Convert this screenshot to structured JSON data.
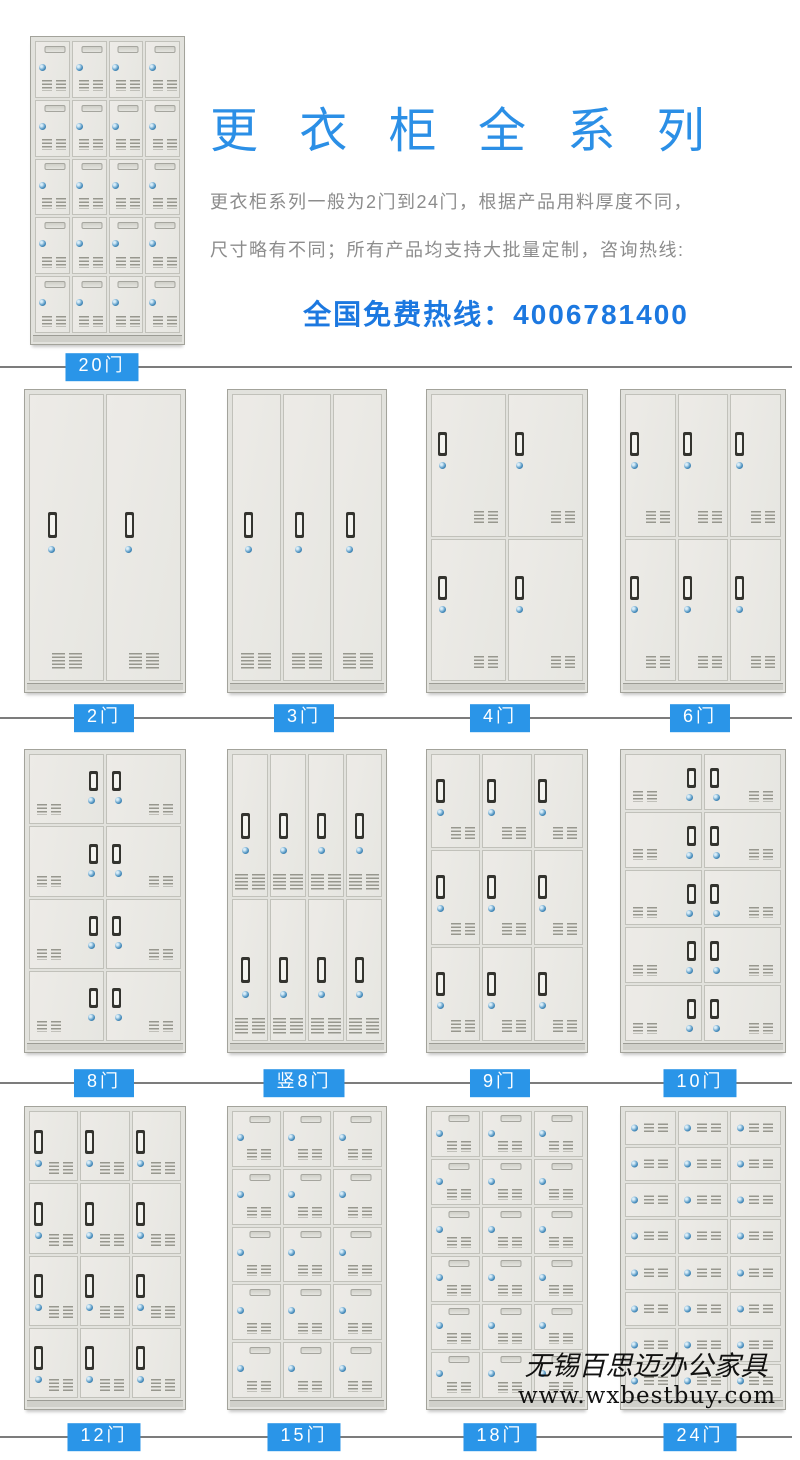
{
  "header": {
    "title": "更 衣 柜 全 系 列",
    "desc_line1": "更衣柜系列一般为2门到24门，根据产品用料厚度不同，",
    "desc_line2": "尺寸略有不同；所有产品均支持大批量定制，咨询热线:",
    "hotline": "全国免费热线：4006781400"
  },
  "colors": {
    "title_blue": "#2b8fe6",
    "hotline_blue": "#1c78e0",
    "label_bg_blue": "#2a95e8",
    "text_gray": "#8c8c8c",
    "divider_gray": "#7c7c7c",
    "locker_body": "#e8e8e3"
  },
  "hero_locker": {
    "label": "20门",
    "cols": 4,
    "rows": 5,
    "style": "flat"
  },
  "rows": [
    {
      "lockers": [
        {
          "label": "2门",
          "cols": 2,
          "rows": 1,
          "style": "tall"
        },
        {
          "label": "3门",
          "cols": 3,
          "rows": 1,
          "style": "tall"
        },
        {
          "label": "4门",
          "cols": 2,
          "rows": 2,
          "style": "left"
        },
        {
          "label": "6门",
          "cols": 3,
          "rows": 2,
          "style": "left"
        }
      ]
    },
    {
      "lockers": [
        {
          "label": "8门",
          "cols": 2,
          "rows": 4,
          "style": "center"
        },
        {
          "label": "竖8门",
          "cols": 4,
          "rows": 2,
          "style": "tall"
        },
        {
          "label": "9门",
          "cols": 3,
          "rows": 3,
          "style": "left"
        },
        {
          "label": "10门",
          "cols": 2,
          "rows": 5,
          "style": "center"
        }
      ]
    },
    {
      "lockers": [
        {
          "label": "12门",
          "cols": 3,
          "rows": 4,
          "style": "left"
        },
        {
          "label": "15门",
          "cols": 3,
          "rows": 5,
          "style": "flat"
        },
        {
          "label": "18门",
          "cols": 3,
          "rows": 6,
          "style": "flat"
        },
        {
          "label": "24门",
          "cols": 3,
          "rows": 8,
          "style": "mini"
        }
      ]
    }
  ],
  "watermark": {
    "line1": "无锡百思迈办公家具",
    "line2": "www.wxbestbuy.com"
  }
}
